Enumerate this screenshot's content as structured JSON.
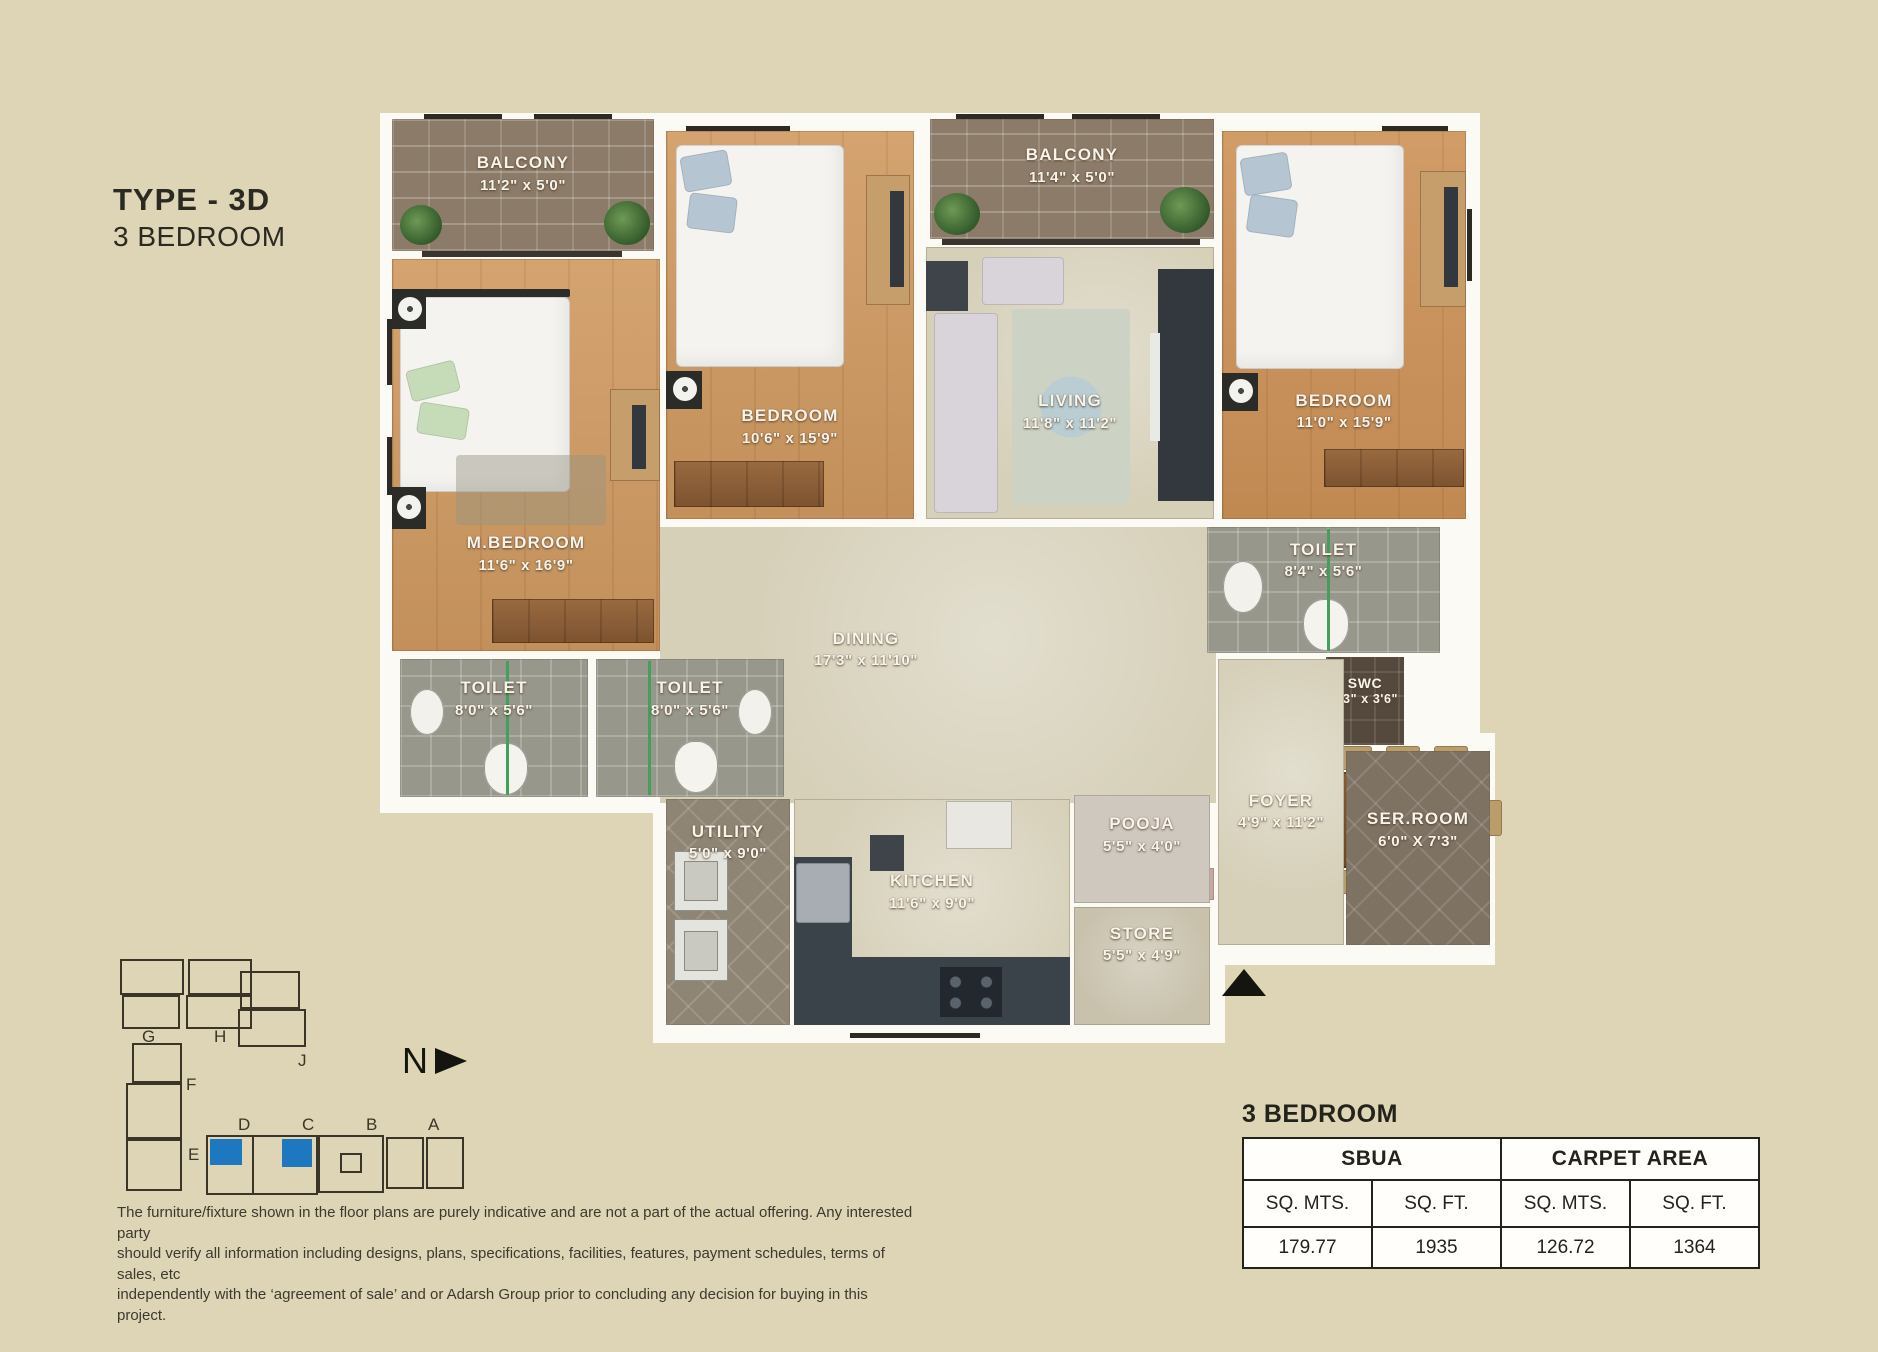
{
  "header": {
    "title": "TYPE - 3D",
    "subtitle": "3 BEDROOM"
  },
  "rooms": [
    {
      "id": "balcony-1",
      "name": "BALCONY",
      "dims": "11'2\" x 5'0\""
    },
    {
      "id": "m-bedroom",
      "name": "M.BEDROOM",
      "dims": "11'6\" x 16'9\""
    },
    {
      "id": "bedroom-2",
      "name": "BEDROOM",
      "dims": "10'6\" x 15'9\""
    },
    {
      "id": "balcony-2",
      "name": "BALCONY",
      "dims": "11'4\" x 5'0\""
    },
    {
      "id": "living",
      "name": "LIVING",
      "dims": "11'8\" x 11'2\""
    },
    {
      "id": "bedroom-3",
      "name": "BEDROOM",
      "dims": "11'0\" x 15'9\""
    },
    {
      "id": "toilet-3",
      "name": "TOILET",
      "dims": "8'4\" x 5'6\""
    },
    {
      "id": "toilet-1",
      "name": "TOILET",
      "dims": "8'0\" x 5'6\""
    },
    {
      "id": "toilet-2",
      "name": "TOILET",
      "dims": "8'0\" x 5'6\""
    },
    {
      "id": "dining",
      "name": "DINING",
      "dims": "17'3\" x 11'10\""
    },
    {
      "id": "swc",
      "name": "SWC",
      "dims": "3'3\" x 3'6\""
    },
    {
      "id": "foyer",
      "name": "FOYER",
      "dims": "4'9\" x 11'2\""
    },
    {
      "id": "ser-room",
      "name": "SER.ROOM",
      "dims": "6'0\" X 7'3\""
    },
    {
      "id": "utility",
      "name": "UTILITY",
      "dims": "5'0\" x 9'0\""
    },
    {
      "id": "kitchen",
      "name": "KITCHEN",
      "dims": "11'6\" x 9'0\""
    },
    {
      "id": "pooja",
      "name": "POOJA",
      "dims": "5'5\" x 4'0\""
    },
    {
      "id": "store",
      "name": "STORE",
      "dims": "5'5\" x 4'9\""
    }
  ],
  "keyplan": {
    "labels": [
      "G",
      "H",
      "J",
      "F",
      "E",
      "D",
      "C",
      "B",
      "A"
    ],
    "highlight_color": "#1d78c0"
  },
  "north": {
    "label": "N"
  },
  "disclaimer": {
    "line1": "The furniture/fixture shown in the floor plans are purely indicative and are not a part of the actual offering. Any interested party",
    "line2": "should verify all information including designs, plans, specifications, facilities, features, payment schedules, terms of sales, etc",
    "line3": "independently with the ‘agreement of sale’ and or Adarsh Group prior to concluding any decision for buying in this project."
  },
  "area_table": {
    "title": "3 BEDROOM",
    "col_groups": [
      "SBUA",
      "CARPET AREA"
    ],
    "sub_headers": [
      "SQ. MTS.",
      "SQ. FT.",
      "SQ. MTS.",
      "SQ. FT."
    ],
    "values": [
      "179.77",
      "1935",
      "126.72",
      "1364"
    ]
  },
  "colors": {
    "background": "#ddd5b5",
    "accent_blue": "#1d78c0",
    "wood_floor": "#cf9960",
    "tile_gray": "#98978c",
    "wall_white": "#fbfaf5",
    "table_border": "#23231b"
  }
}
